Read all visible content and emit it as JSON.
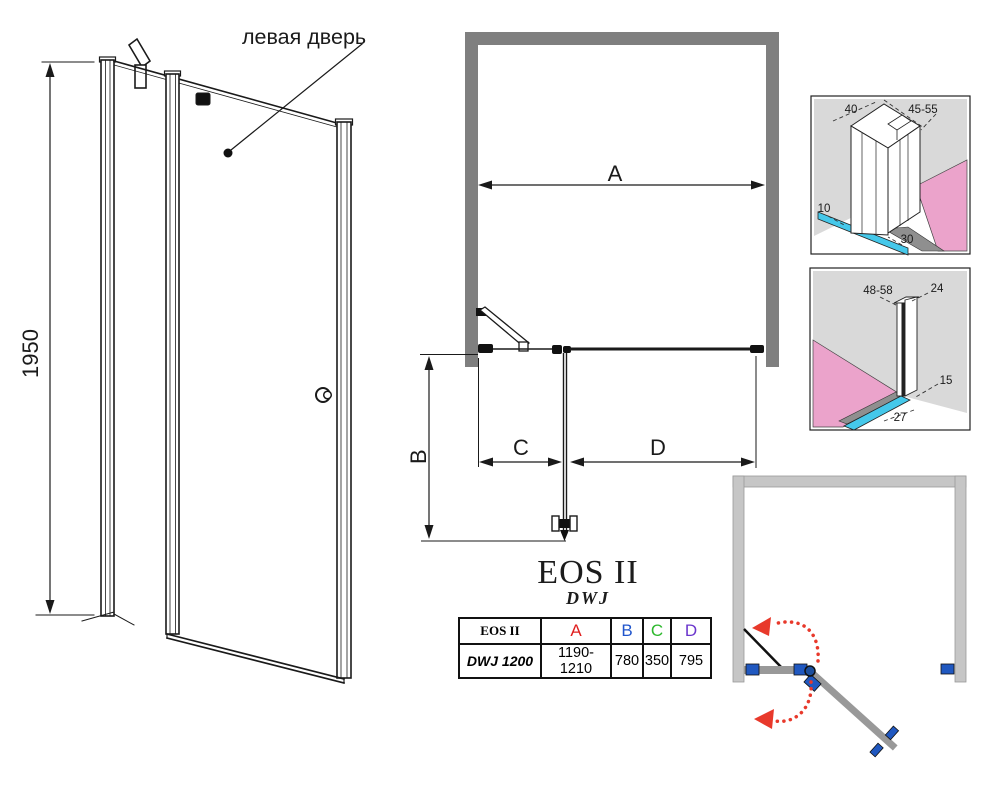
{
  "front_view": {
    "door_label": "левая дверь",
    "height_dim": "1950"
  },
  "top_view": {
    "dim_a": "A",
    "dim_b": "B",
    "dim_c": "C",
    "dim_d": "D"
  },
  "detail_top": {
    "dim_width": "40",
    "dim_depth": "45-55",
    "dim_gap": "10",
    "dim_strip": "30"
  },
  "detail_bottom": {
    "dim_range": "48-58",
    "dim_width": "24",
    "dim_offset": "15",
    "dim_strip": "27"
  },
  "product": {
    "series": "EOS II",
    "model": "DWJ"
  },
  "table": {
    "col_product": "EOS II",
    "col_a": "A",
    "col_b": "B",
    "col_c": "C",
    "col_d": "D",
    "row_model": "DWJ 1200",
    "row_a": "1190-1210",
    "row_b": "780",
    "row_c": "350",
    "row_d": "795"
  },
  "colors": {
    "dim_a": "#e01f1f",
    "dim_b_diagram": "#4d3fd4",
    "dim_c": "#2db82d",
    "dim_d_diagram": "#1b64c8",
    "table_a": "#e01f1f",
    "table_b": "#2055cc",
    "table_c": "#2db82d",
    "table_d": "#6a35cc",
    "wall_gray": "#7f7f7f",
    "swing_wall_gray": "#c6c6c6",
    "accent_blue": "#2058c0",
    "glass_cyan": "#45c8ea",
    "wall_pink": "#eba3cb",
    "arc_red": "#e8392b"
  }
}
